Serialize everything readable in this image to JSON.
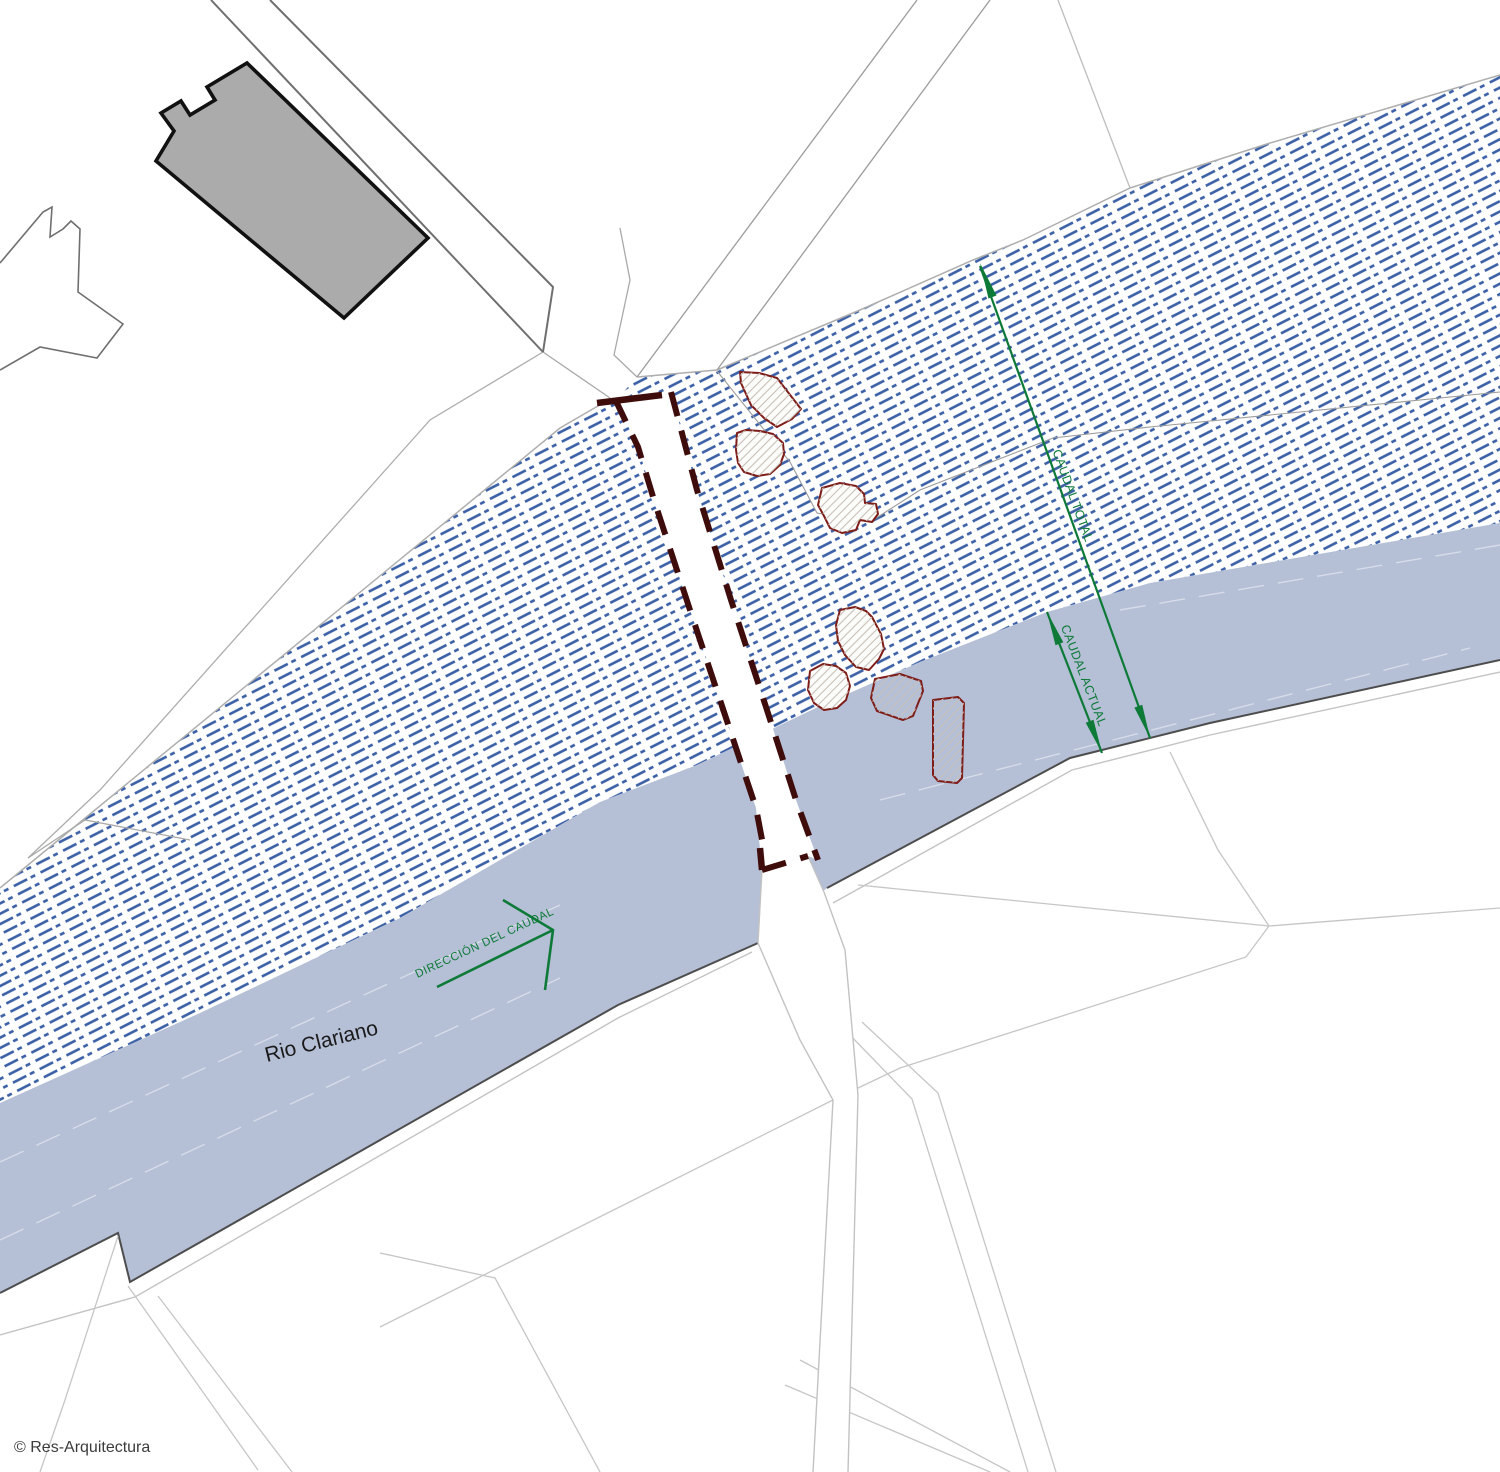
{
  "annotations": {
    "caudal_total": "CAUDAL TOTAL",
    "caudal_actual": "CAUDAL ACTUAL",
    "direccion_del_caudal": "DIRECCIÓN DEL CAUDAL",
    "river_name": "Rio Clariano",
    "copyright": "© Res-Arquitectura"
  },
  "colors": {
    "flood_hatch_blue": "#3d61a6",
    "river_fill": "#b5bfd6",
    "annotation_green": "#0d7a37",
    "bridge_dashed_outline": "#3f0c0c",
    "building_footprint_outline": "#7e1d18",
    "main_building_fill": "#ababab",
    "parcel_line_gray": "#c6c6c6",
    "river_bank_dark": "#4d4d4d"
  }
}
